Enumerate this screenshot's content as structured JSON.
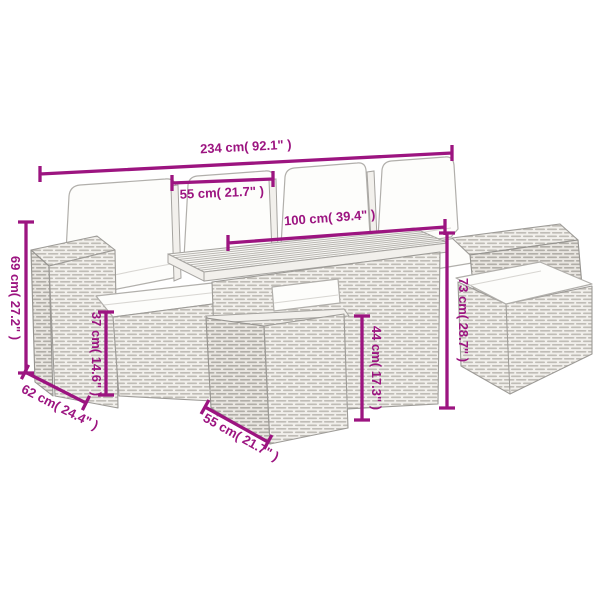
{
  "image": {
    "kind": "product-dimension-diagram",
    "subject": "poly rattan garden lounge set with table, stools and white cushions",
    "background": "#ffffff"
  },
  "colors": {
    "accent": "#9c1480",
    "furniture_outline": "#9d9b97",
    "cushion_fill": "#fdfdfb"
  },
  "dimensions": [
    {
      "id": "overall-width",
      "cm": "234",
      "inch": "92.1",
      "label": "234 cm( 92.1\" )"
    },
    {
      "id": "seat-width",
      "cm": "55",
      "inch": "21.7",
      "label": "55 cm( 21.7\" )"
    },
    {
      "id": "table-length",
      "cm": "100",
      "inch": "39.4",
      "label": "100 cm( 39.4\" )"
    },
    {
      "id": "back-height",
      "cm": "69",
      "inch": "27.2",
      "label": "69 cm( 27.2\" )"
    },
    {
      "id": "seat-height",
      "cm": "37",
      "inch": "14.6",
      "label": "37 cm( 14.6\" )"
    },
    {
      "id": "seat-depth",
      "cm": "62",
      "inch": "24.4",
      "label": "62 cm( 24.4\" )"
    },
    {
      "id": "stool-height",
      "cm": "44",
      "inch": "17.3",
      "label": "44 cm( 17.3\" )"
    },
    {
      "id": "table-height",
      "cm": "73",
      "inch": "28.7",
      "label": "73 cm( 28.7\" )"
    },
    {
      "id": "stool-depth",
      "cm": "55",
      "inch": "21.7",
      "label": "55 cm( 21.7\" )"
    }
  ]
}
